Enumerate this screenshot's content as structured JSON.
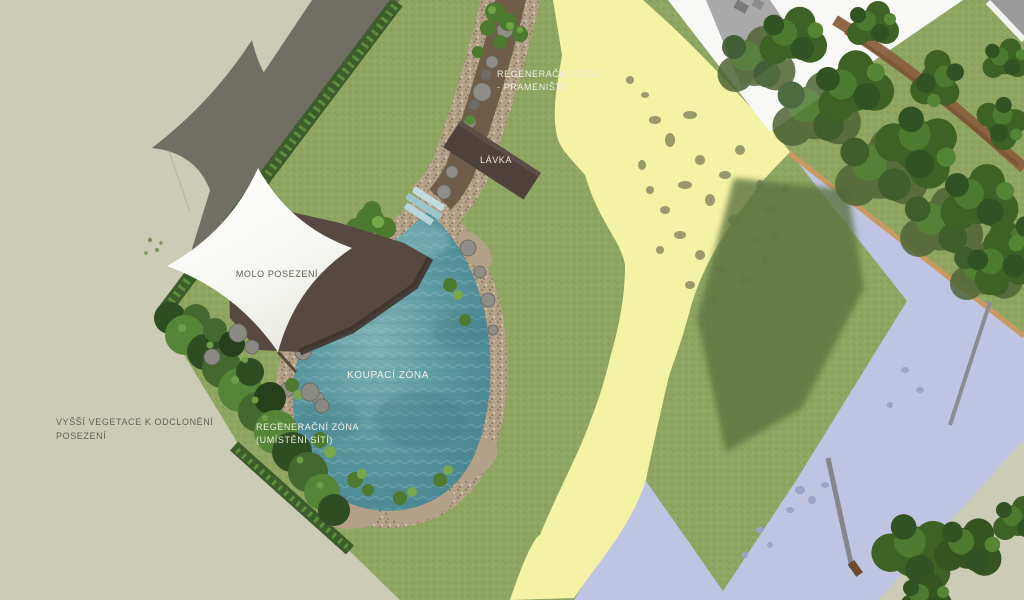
{
  "plan": {
    "labels": {
      "regen_spring_l1": "REGENERAČNÍ ZÓNA",
      "regen_spring_l2": "- PRAMENIŠTĚ",
      "bridge": "LÁVKA",
      "deck": "MOLO POSEZENÍ",
      "swim": "KOUPACÍ ZÓNA",
      "regen_nets_l1": "REGENERAČNÍ ZÓNA",
      "regen_nets_l2": "(UMÍSTĚNÍ SÍTÍ)",
      "veg_l1": "VYŠŠÍ VEGETACE K ODCLONĚNÍ",
      "veg_l2": "POSEZENÍ"
    },
    "colors": {
      "surround": "#cccbb5",
      "shadow_band": "#716f64",
      "lawn": "#8fa562",
      "hedge": "#3c5c2c",
      "hedge_light": "#679a41",
      "path": "#f4f2a4",
      "paved_area": "#bfc4e2",
      "paved_shadow": "#9ba4c9",
      "water_mid": "#5d9aa1",
      "water_deep": "#457f8c",
      "water_light": "#7fb3b6",
      "gravel": "#b3a088",
      "soil": "#6f5d4a",
      "stone": "#8f8d85",
      "deck": "#584842",
      "bridge": "#4e403a",
      "sail": "#fdfdfb",
      "building": "#f8f8f6",
      "building_roof": "#a9a9a9",
      "dirt_road": "#8a5f3e",
      "edge_strip": "#c89a62",
      "tree": "#3e6125",
      "tree_shadow": "#5c7340",
      "dapple": "#83835f",
      "label_light": "#efefe6",
      "label_dark": "#5f5f55"
    }
  }
}
